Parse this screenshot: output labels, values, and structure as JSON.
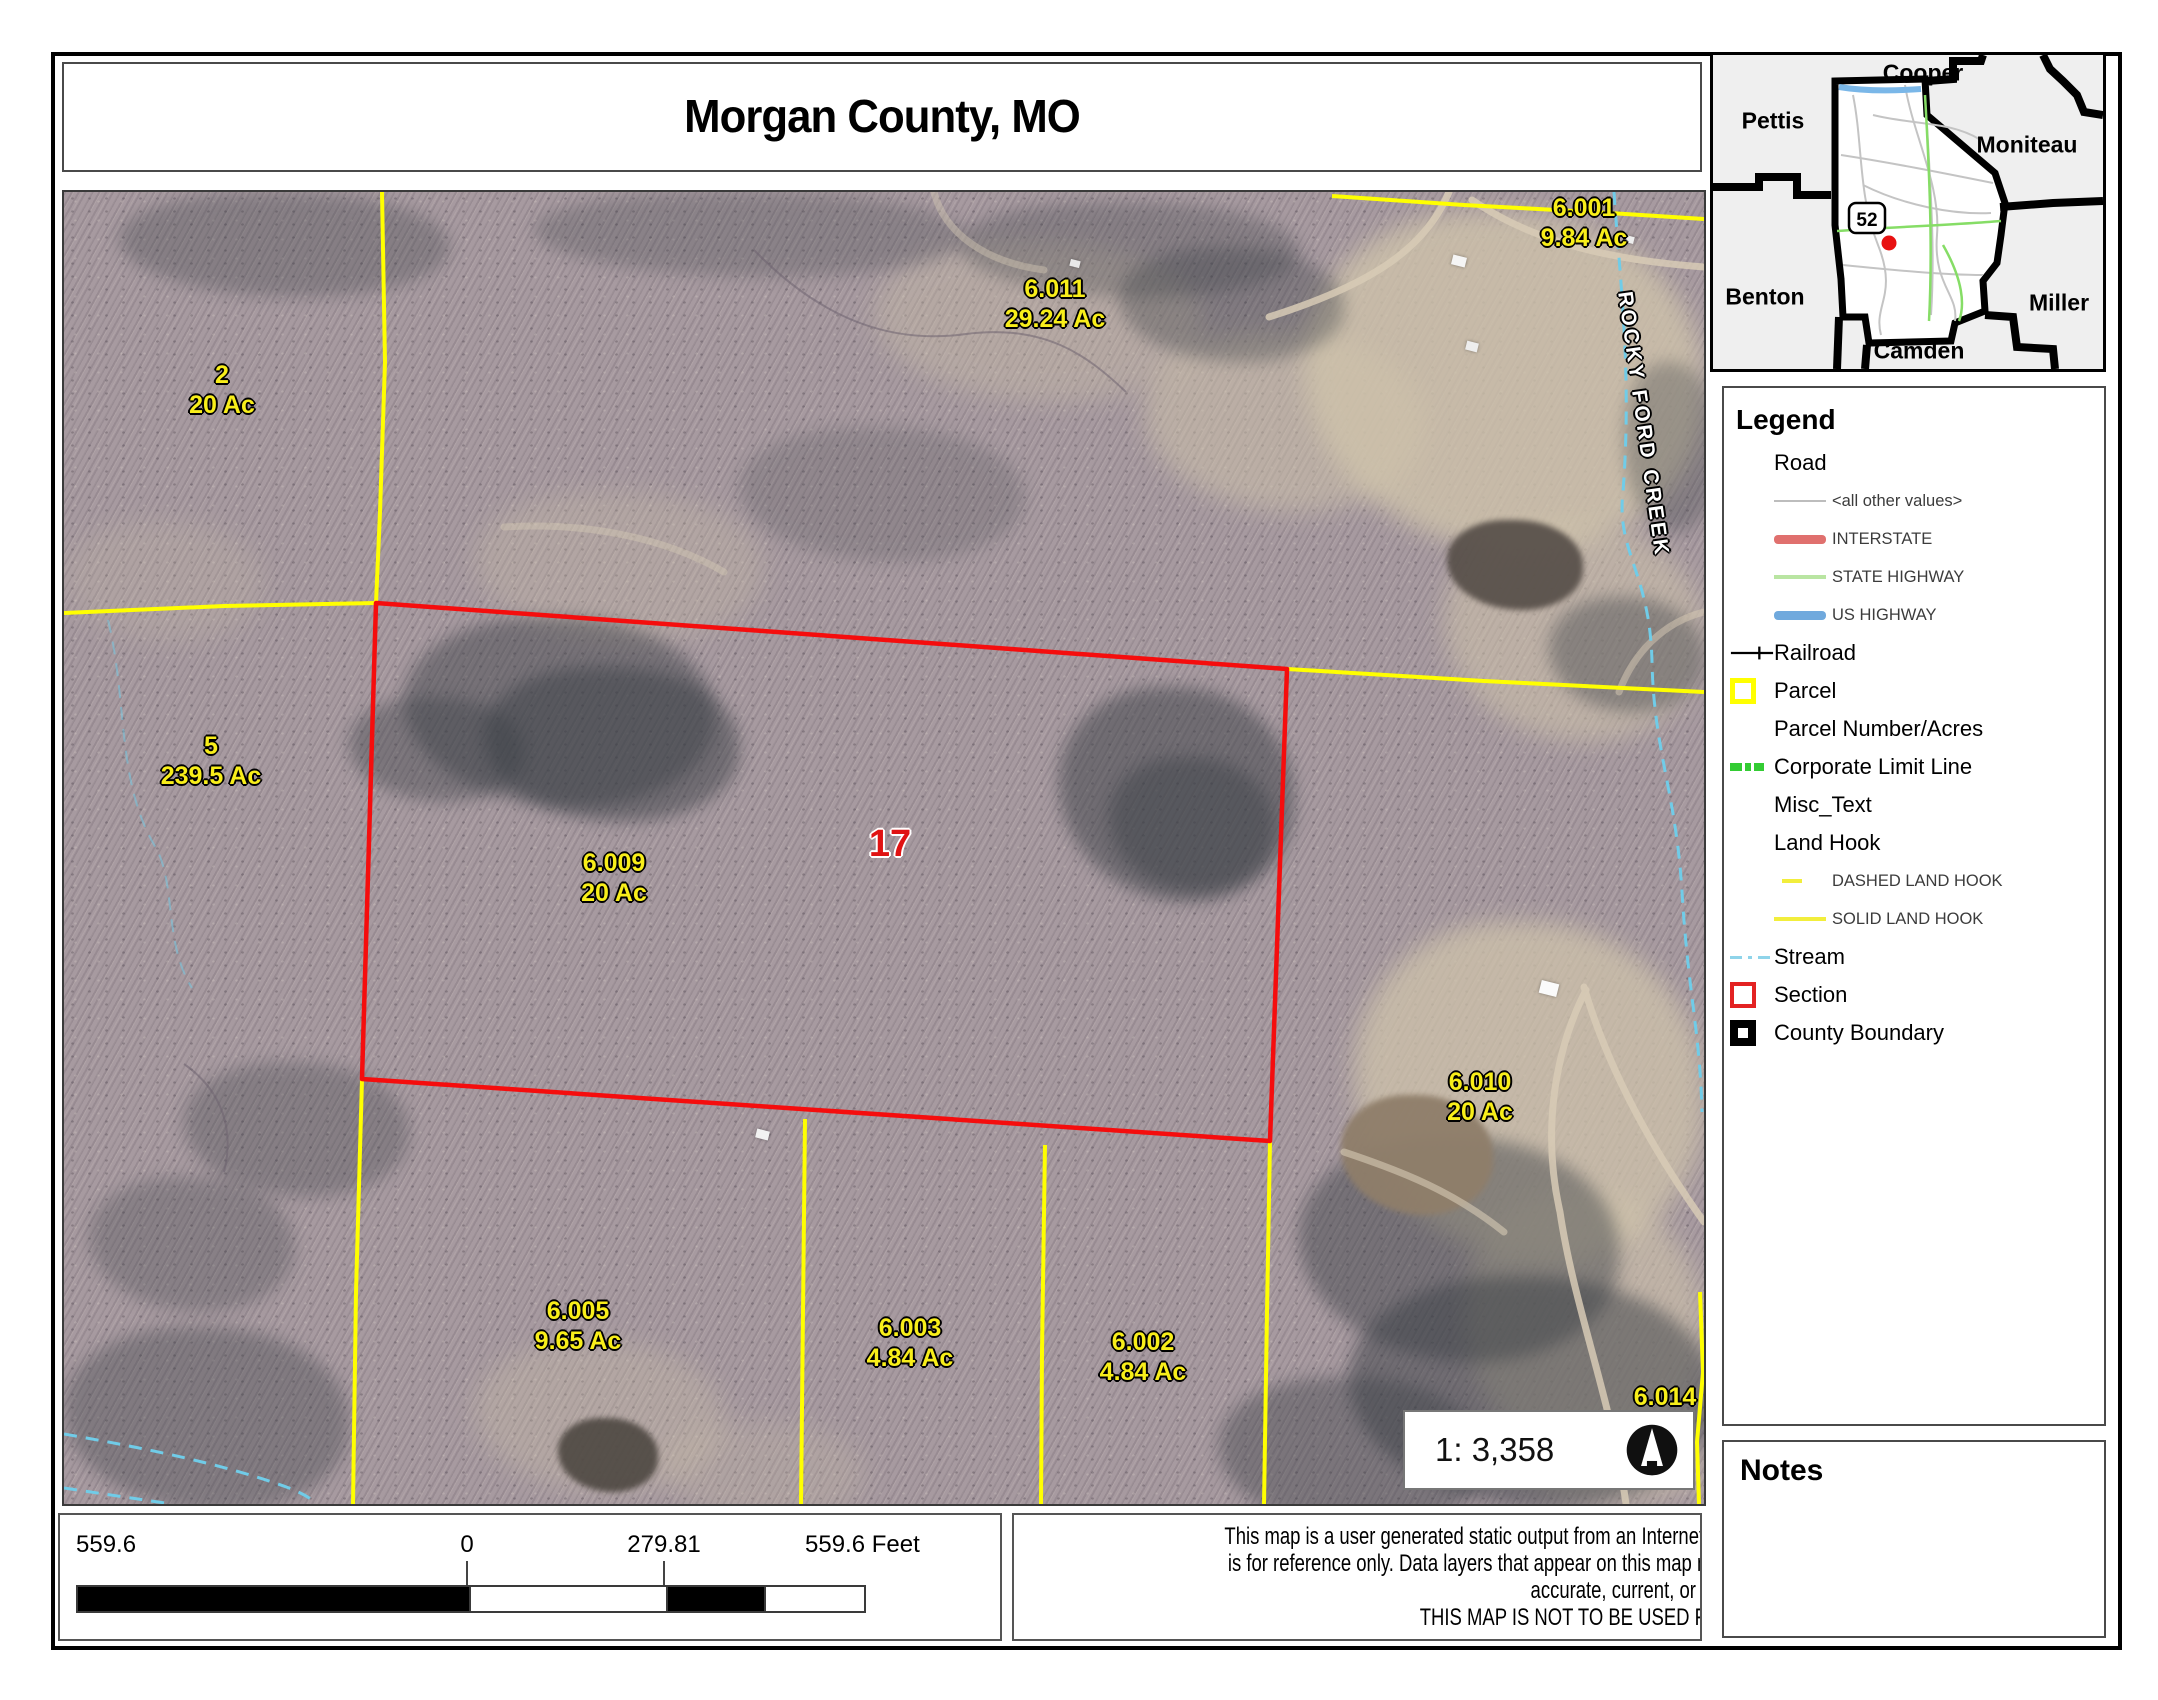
{
  "page": {
    "title": "Morgan County, MO"
  },
  "inset_map": {
    "highway_shield": "52",
    "counties": [
      {
        "name": "Pettis",
        "x": 60,
        "y": 66
      },
      {
        "name": "Cooper",
        "x": 210,
        "y": 18
      },
      {
        "name": "Moniteau",
        "x": 314,
        "y": 90
      },
      {
        "name": "Benton",
        "x": 52,
        "y": 242
      },
      {
        "name": "Miller",
        "x": 346,
        "y": 248
      },
      {
        "name": "Camden",
        "x": 206,
        "y": 296
      }
    ]
  },
  "legend": {
    "title": "Legend",
    "items": [
      {
        "label": "Road",
        "level": 1,
        "symbol": "none"
      },
      {
        "label": "<all other values>",
        "level": 2,
        "symbol": "line",
        "color": "#bdbdbd",
        "weight": 2
      },
      {
        "label": "INTERSTATE",
        "level": 2,
        "symbol": "line",
        "color": "#e0706e",
        "weight": 9
      },
      {
        "label": "STATE HIGHWAY",
        "level": 2,
        "symbol": "line",
        "color": "#b9e5a2",
        "weight": 4
      },
      {
        "label": "US HIGHWAY",
        "level": 2,
        "symbol": "line",
        "color": "#70a9dd",
        "weight": 9
      },
      {
        "label": "Railroad",
        "level": 1,
        "symbol": "railroad",
        "color": "#000000"
      },
      {
        "label": "Parcel",
        "level": 1,
        "symbol": "square",
        "color": "#ffff00",
        "weight": 5
      },
      {
        "label": "Parcel Number/Acres",
        "level": 1,
        "symbol": "none"
      },
      {
        "label": "Corporate Limit Line",
        "level": 1,
        "symbol": "dashblocks",
        "color": "#33cc33"
      },
      {
        "label": "Misc_Text",
        "level": 1,
        "symbol": "none"
      },
      {
        "label": "Land Hook",
        "level": 1,
        "symbol": "none"
      },
      {
        "label": "DASHED LAND HOOK",
        "level": 2,
        "symbol": "shortdash",
        "color": "#f2ee3c"
      },
      {
        "label": "SOLID LAND HOOK",
        "level": 2,
        "symbol": "line",
        "color": "#f2ee3c",
        "weight": 4
      },
      {
        "label": "Stream",
        "level": 1,
        "symbol": "dashline",
        "color": "#8fd4ea"
      },
      {
        "label": "Section",
        "level": 1,
        "symbol": "square",
        "color": "#e32222",
        "weight": 4
      },
      {
        "label": "County Boundary",
        "level": 1,
        "symbol": "square",
        "color": "#000000",
        "weight": 8
      }
    ]
  },
  "map": {
    "section_label": "17",
    "creek_label": "ROCKY FORD CREEK",
    "parcel_text_color": "#f8ee1a",
    "section_outline_color": "#f50d0d",
    "parcel_line_color": "#ffff00",
    "stream_color": "#70cce8",
    "parcels": [
      {
        "num": "2",
        "acres": "20 Ac",
        "x": 158,
        "y": 199
      },
      {
        "num": "6.011",
        "acres": "29.24 Ac",
        "x": 991,
        "y": 113
      },
      {
        "num": "6.001",
        "acres": "9.84 Ac",
        "x": 1520,
        "y": 32
      },
      {
        "num": "5",
        "acres": "239.5 Ac",
        "x": 147,
        "y": 570
      },
      {
        "num": "6.009",
        "acres": "20 Ac",
        "x": 550,
        "y": 687
      },
      {
        "num": "6.010",
        "acres": "20 Ac",
        "x": 1416,
        "y": 906
      },
      {
        "num": "6.005",
        "acres": "9.65 Ac",
        "x": 514,
        "y": 1135
      },
      {
        "num": "6.003",
        "acres": "4.84 Ac",
        "x": 846,
        "y": 1152
      },
      {
        "num": "6.002",
        "acres": "4.84 Ac",
        "x": 1079,
        "y": 1166
      },
      {
        "num": "6.014",
        "acres": "",
        "x": 1601,
        "y": 1205
      }
    ]
  },
  "scale_box": {
    "scale_text": "1: 3,358"
  },
  "scalebar": {
    "labels": [
      {
        "text": "559.6",
        "x": 16,
        "anchor": "left"
      },
      {
        "text": "0",
        "x": 407,
        "anchor": "center"
      },
      {
        "text": "279.81",
        "x": 604,
        "anchor": "center"
      },
      {
        "text": "559.6 Feet",
        "x": 745,
        "anchor": "left"
      }
    ],
    "segments": [
      {
        "width": 391,
        "color": "#000000"
      },
      {
        "width": 197,
        "color": "#ffffff"
      },
      {
        "width": 98,
        "color": "#000000"
      },
      {
        "width": 100,
        "color": "#ffffff"
      }
    ]
  },
  "disclaimer": {
    "lines": [
      "This map is a user generated static output from an Internet mapping site and",
      "is for reference only. Data layers that appear on this map may or may not be",
      "accurate, current, or otherwise reliable.",
      "THIS MAP IS NOT TO BE USED FOR NAVIGATION"
    ]
  },
  "notes": {
    "title": "Notes"
  }
}
